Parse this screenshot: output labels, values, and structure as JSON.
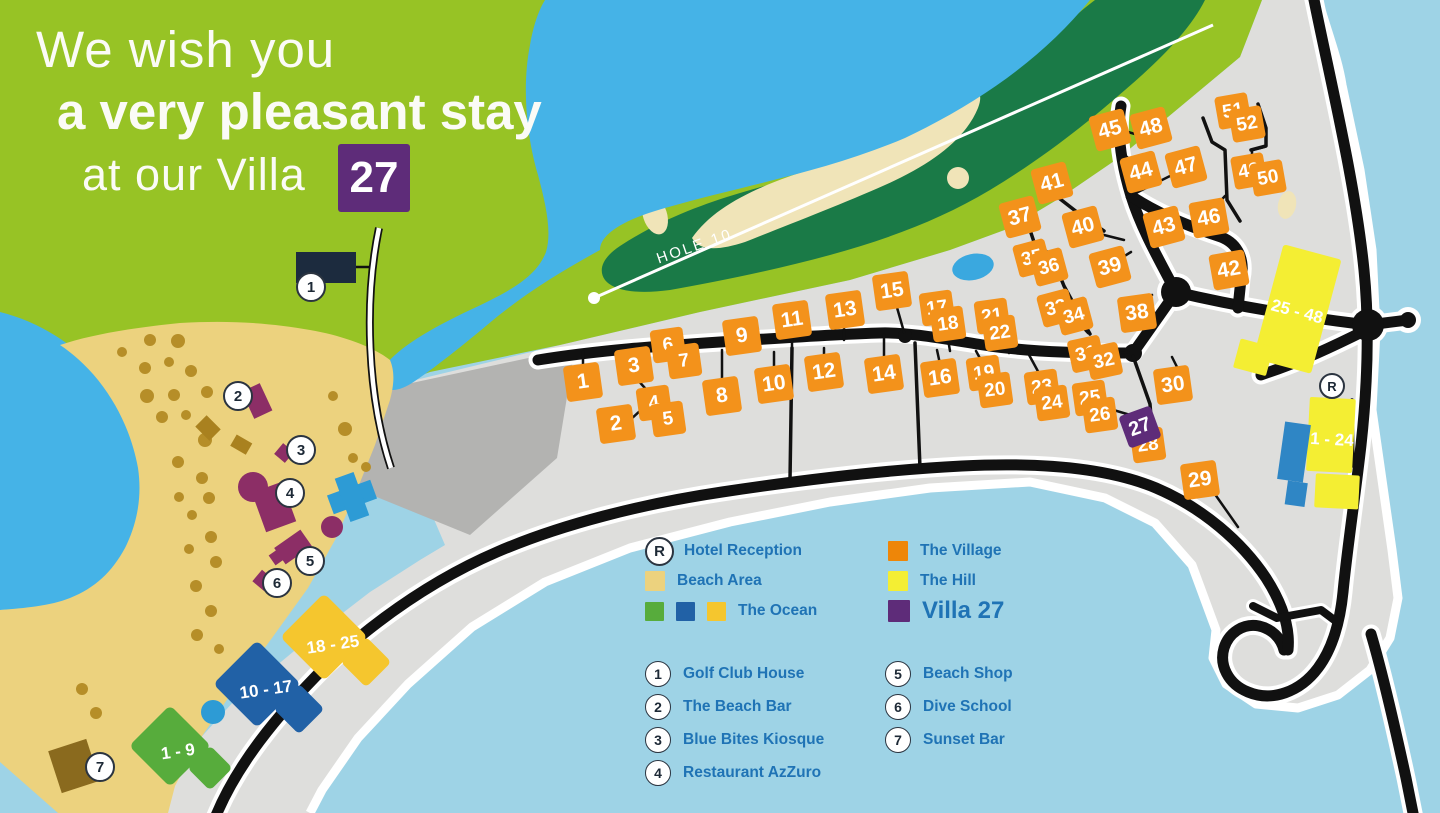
{
  "title": {
    "line1": "We wish you",
    "line2": "a very pleasant stay",
    "line3": "at our Villa",
    "villa_number": "27"
  },
  "map": {
    "hole_label": "HOLE 10",
    "reception_letter": "R",
    "reception": {
      "x": 1332,
      "y": 386
    },
    "villas": [
      {
        "n": 1,
        "x": 583,
        "y": 382,
        "r": -8,
        "s": 36
      },
      {
        "n": 2,
        "x": 616,
        "y": 424,
        "r": -8,
        "s": 36
      },
      {
        "n": 3,
        "x": 634,
        "y": 366,
        "r": -8,
        "s": 36
      },
      {
        "n": 4,
        "x": 654,
        "y": 403,
        "r": -8,
        "s": 33
      },
      {
        "n": 5,
        "x": 668,
        "y": 419,
        "r": -8,
        "s": 33
      },
      {
        "n": 6,
        "x": 668,
        "y": 345,
        "r": -8,
        "s": 33
      },
      {
        "n": 7,
        "x": 684,
        "y": 361,
        "r": -8,
        "s": 33
      },
      {
        "n": 8,
        "x": 722,
        "y": 396,
        "r": -8,
        "s": 36
      },
      {
        "n": 9,
        "x": 742,
        "y": 336,
        "r": -8,
        "s": 36
      },
      {
        "n": 10,
        "x": 774,
        "y": 384,
        "r": -8,
        "s": 36
      },
      {
        "n": 11,
        "x": 792,
        "y": 320,
        "r": -8,
        "s": 36
      },
      {
        "n": 12,
        "x": 824,
        "y": 372,
        "r": -8,
        "s": 36
      },
      {
        "n": 13,
        "x": 845,
        "y": 310,
        "r": -8,
        "s": 36
      },
      {
        "n": 14,
        "x": 884,
        "y": 374,
        "r": -8,
        "s": 36
      },
      {
        "n": 15,
        "x": 892,
        "y": 291,
        "r": -8,
        "s": 36
      },
      {
        "n": 16,
        "x": 940,
        "y": 378,
        "r": -8,
        "s": 36
      },
      {
        "n": 17,
        "x": 937,
        "y": 308,
        "r": -8,
        "s": 33
      },
      {
        "n": 18,
        "x": 948,
        "y": 324,
        "r": -8,
        "s": 33
      },
      {
        "n": 19,
        "x": 984,
        "y": 373,
        "r": -8,
        "s": 33
      },
      {
        "n": 20,
        "x": 995,
        "y": 390,
        "r": -8,
        "s": 33
      },
      {
        "n": 21,
        "x": 992,
        "y": 316,
        "r": -8,
        "s": 33
      },
      {
        "n": 22,
        "x": 1000,
        "y": 333,
        "r": -8,
        "s": 33
      },
      {
        "n": 23,
        "x": 1042,
        "y": 387,
        "r": -8,
        "s": 33
      },
      {
        "n": 24,
        "x": 1052,
        "y": 403,
        "r": -8,
        "s": 33
      },
      {
        "n": 25,
        "x": 1090,
        "y": 398,
        "r": -8,
        "s": 33
      },
      {
        "n": 26,
        "x": 1100,
        "y": 415,
        "r": -8,
        "s": 33
      },
      {
        "n": 27,
        "x": 1140,
        "y": 427,
        "r": -20,
        "s": 34,
        "purple": true,
        "z": 3
      },
      {
        "n": 28,
        "x": 1148,
        "y": 445,
        "r": -8,
        "s": 33
      },
      {
        "n": 29,
        "x": 1200,
        "y": 480,
        "r": -8,
        "s": 36
      },
      {
        "n": 30,
        "x": 1173,
        "y": 385,
        "r": -8,
        "s": 36
      },
      {
        "n": 31,
        "x": 1086,
        "y": 354,
        "r": -12,
        "s": 33
      },
      {
        "n": 32,
        "x": 1104,
        "y": 361,
        "r": -12,
        "s": 33
      },
      {
        "n": 33,
        "x": 1056,
        "y": 308,
        "r": -15,
        "s": 33
      },
      {
        "n": 34,
        "x": 1074,
        "y": 316,
        "r": -15,
        "s": 33
      },
      {
        "n": 35,
        "x": 1032,
        "y": 258,
        "r": -15,
        "s": 33
      },
      {
        "n": 36,
        "x": 1049,
        "y": 267,
        "r": -15,
        "s": 33
      },
      {
        "n": 37,
        "x": 1020,
        "y": 217,
        "r": -15,
        "s": 36
      },
      {
        "n": 38,
        "x": 1137,
        "y": 313,
        "r": -8,
        "s": 36
      },
      {
        "n": 39,
        "x": 1110,
        "y": 267,
        "r": -15,
        "s": 36
      },
      {
        "n": 40,
        "x": 1083,
        "y": 227,
        "r": -15,
        "s": 36
      },
      {
        "n": 41,
        "x": 1052,
        "y": 183,
        "r": -15,
        "s": 36
      },
      {
        "n": 42,
        "x": 1229,
        "y": 270,
        "r": -10,
        "s": 36
      },
      {
        "n": 43,
        "x": 1164,
        "y": 227,
        "r": -15,
        "s": 36
      },
      {
        "n": 44,
        "x": 1141,
        "y": 172,
        "r": -15,
        "s": 36
      },
      {
        "n": 45,
        "x": 1110,
        "y": 130,
        "r": -15,
        "s": 36
      },
      {
        "n": 46,
        "x": 1209,
        "y": 218,
        "r": -10,
        "s": 36
      },
      {
        "n": 47,
        "x": 1186,
        "y": 167,
        "r": -15,
        "s": 36
      },
      {
        "n": 48,
        "x": 1151,
        "y": 128,
        "r": -15,
        "s": 36
      },
      {
        "n": 49,
        "x": 1249,
        "y": 171,
        "r": -10,
        "s": 33
      },
      {
        "n": 50,
        "x": 1268,
        "y": 178,
        "r": -10,
        "s": 33
      },
      {
        "n": 51,
        "x": 1233,
        "y": 111,
        "r": -10,
        "s": 33
      },
      {
        "n": 52,
        "x": 1247,
        "y": 124,
        "r": -10,
        "s": 33
      }
    ],
    "pois": [
      {
        "n": 1,
        "x": 311,
        "y": 287
      },
      {
        "n": 2,
        "x": 238,
        "y": 396
      },
      {
        "n": 3,
        "x": 301,
        "y": 450
      },
      {
        "n": 4,
        "x": 290,
        "y": 493
      },
      {
        "n": 5,
        "x": 310,
        "y": 561
      },
      {
        "n": 6,
        "x": 277,
        "y": 583
      },
      {
        "n": 7,
        "x": 100,
        "y": 767
      }
    ],
    "area_buildings": [
      {
        "label": "18 - 25",
        "x": 333,
        "y": 645,
        "rot": -8
      },
      {
        "label": "10 - 17",
        "x": 266,
        "y": 690,
        "rot": -8
      },
      {
        "label": "1 - 9",
        "x": 178,
        "y": 752,
        "rot": -8
      },
      {
        "label": "25 - 48",
        "x": 1297,
        "y": 312,
        "rot": 15
      },
      {
        "label": "1 - 24",
        "x": 1332,
        "y": 440,
        "rot": 3
      }
    ]
  },
  "legend": {
    "areas": [
      {
        "label": "Hotel Reception",
        "swatch": "reception",
        "col": 1
      },
      {
        "label": "Beach Area",
        "swatch": "single",
        "color": "#ECD27E",
        "col": 1
      },
      {
        "label": "The Ocean",
        "swatch": "triple",
        "colors": [
          "#57AC3C",
          "#2161A6",
          "#F5C62E"
        ],
        "col": 1
      },
      {
        "label": "The Village",
        "swatch": "single",
        "color": "#EE8608",
        "col": 2
      },
      {
        "label": "The Hill",
        "swatch": "single",
        "color": "#F4EE33",
        "col": 2
      },
      {
        "label": "Villa 27",
        "swatch": "single",
        "color": "#5E2C79",
        "col": 2,
        "big": true
      }
    ],
    "numbered": [
      {
        "n": 1,
        "label": "Golf Club House",
        "col": 1
      },
      {
        "n": 2,
        "label": "The Beach Bar",
        "col": 1
      },
      {
        "n": 3,
        "label": "Blue Bites Kiosque",
        "col": 1
      },
      {
        "n": 4,
        "label": "Restaurant AzZuro",
        "col": 1
      },
      {
        "n": 5,
        "label": "Beach Shop",
        "col": 2
      },
      {
        "n": 6,
        "label": "Dive School",
        "col": 2
      },
      {
        "n": 7,
        "label": "Sunset Bar",
        "col": 2
      }
    ]
  },
  "colors": {
    "background_green": "#97C325",
    "golf_green": "#1A7A47",
    "lagoon_blue": "#45B3E7",
    "ocean_blue": "#9ED3E6",
    "sand": "#ECD27E",
    "bunker_sand": "#F0E4B8",
    "resort_gray": "#DEDEDC",
    "parking_gray": "#B3B3B1",
    "road_black": "#111111",
    "village_orange": "#F3921B",
    "hill_yellow": "#F4EE33",
    "villa_purple": "#5E2C79",
    "beach_building_plum": "#8C2E66",
    "club_navy": "#1C2B3E",
    "pool_blue": "#2F86C5",
    "legend_text_blue": "#1F73B5"
  }
}
